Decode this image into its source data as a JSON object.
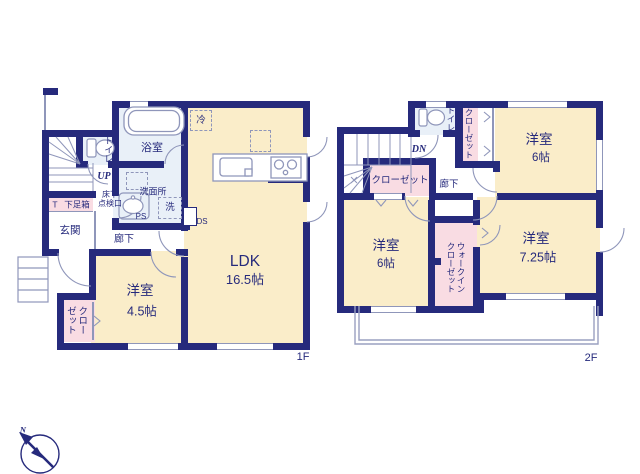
{
  "floor1": {
    "label": "1F",
    "ldk_name": "LDK",
    "ldk_size": "16.5帖",
    "bedroom_name": "洋室",
    "bedroom_size": "4.5帖",
    "bath": "浴室",
    "washroom": "洗面所",
    "toilet": "トイレ",
    "entrance": "玄関",
    "hallway": "廊下",
    "closet": "クローゼット",
    "shoebox": "下足箱",
    "shoebox_t": "T",
    "up": "UP",
    "ps": "PS",
    "ds": "DS",
    "fridge": "冷",
    "washer": "洗",
    "hatch_line1": "床下",
    "hatch_line2": "点検口"
  },
  "floor2": {
    "label": "2F",
    "bedroom_ne_name": "洋室",
    "bedroom_ne_size": "6帖",
    "bedroom_sw_name": "洋室",
    "bedroom_sw_size": "6帖",
    "bedroom_se_name": "洋室",
    "bedroom_se_size": "7.25帖",
    "wic": "ウォークインクローゼット",
    "closet_hall": "クローゼット",
    "closet_ne": "クローゼット",
    "toilet": "トイレ",
    "hallway": "廊下",
    "dn": "DN"
  },
  "compass": {
    "north": "N"
  },
  "colors": {
    "wall": "#262a7c",
    "room_fill": "#faedc9",
    "wet_fill": "#e9f0f8",
    "closet_fill": "#f9dce3",
    "line": "#8f96ba"
  }
}
